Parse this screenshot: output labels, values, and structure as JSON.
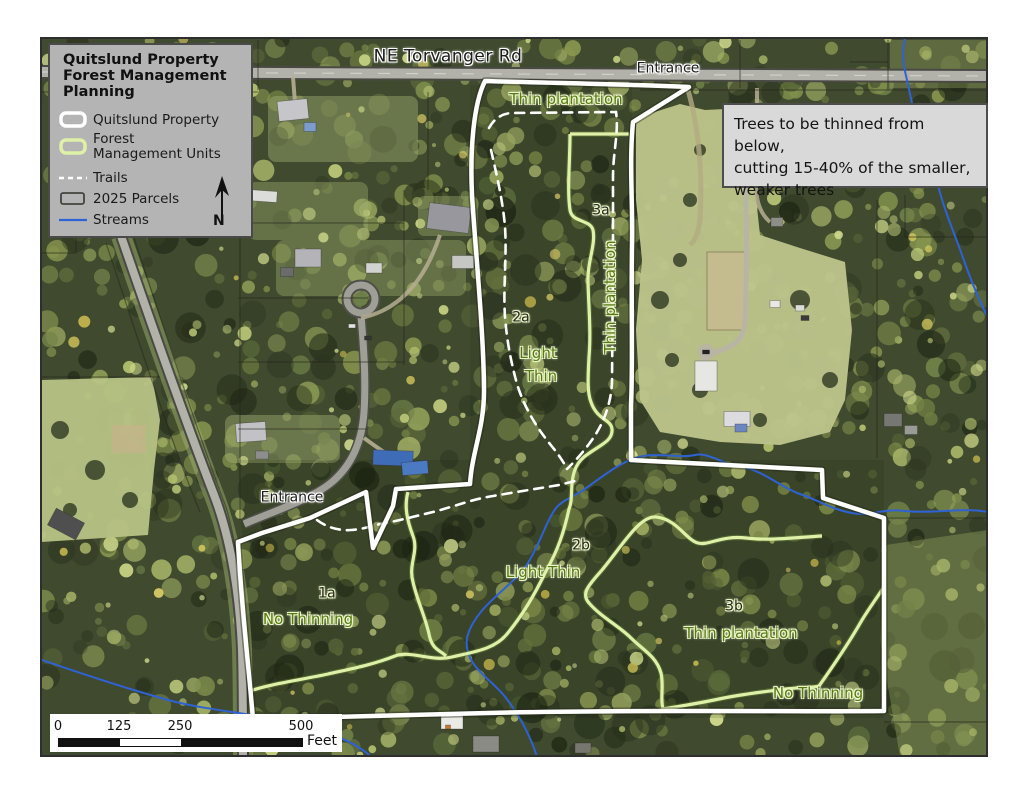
{
  "legend": {
    "title_lines": [
      "Quitslund Property",
      "Forest Management",
      "Planning"
    ],
    "items": [
      {
        "id": "quitslund-property",
        "label": "Quitslund Property",
        "label2": "",
        "symbol": "white-outline"
      },
      {
        "id": "forest-management-units",
        "label": "Forest",
        "label2": "Management Units",
        "symbol": "green-outline"
      },
      {
        "id": "trails",
        "label": "Trails",
        "label2": "",
        "symbol": "white-dash"
      },
      {
        "id": "parcels-2025",
        "label": "2025 Parcels",
        "label2": "",
        "symbol": "dark-rect"
      },
      {
        "id": "streams",
        "label": "Streams",
        "label2": "",
        "symbol": "blue-line"
      }
    ],
    "north_arrow_letter": "N"
  },
  "note_box": {
    "lines": [
      "Trees to be thinned from below,",
      "cutting 15-40% of the smaller,",
      "weaker trees"
    ]
  },
  "scalebar": {
    "ticks": [
      {
        "label": "0",
        "x": 58
      },
      {
        "label": "125",
        "x": 119
      },
      {
        "label": "250",
        "x": 180
      },
      {
        "label": "500",
        "x": 301
      }
    ],
    "unit": "Feet"
  },
  "map_labels": [
    {
      "id": "road-ne-torvanger-rd",
      "text": "NE Torvanger Rd",
      "x": 448,
      "y": 57,
      "kind": "road",
      "rotate": 0
    },
    {
      "id": "entrance-top",
      "text": "Entrance",
      "x": 668,
      "y": 69,
      "kind": "entrance",
      "rotate": 0
    },
    {
      "id": "unit-top-thin-plantation",
      "text": "Thin plantation",
      "x": 566,
      "y": 99,
      "kind": "unit-name",
      "rotate": 0
    },
    {
      "id": "unit-3a-id",
      "text": "3a",
      "x": 601,
      "y": 211,
      "kind": "unit-id",
      "rotate": 0
    },
    {
      "id": "unit-3a-name",
      "text": "Thin plantation",
      "x": 610,
      "y": 297,
      "kind": "unit-name",
      "rotate": -90
    },
    {
      "id": "unit-2a-id",
      "text": "2a",
      "x": 521,
      "y": 318,
      "kind": "unit-id",
      "rotate": 0
    },
    {
      "id": "unit-2a-name-line1",
      "text": "Light",
      "x": 538,
      "y": 353,
      "kind": "unit-name",
      "rotate": 0
    },
    {
      "id": "unit-2a-name-line2",
      "text": "Thin",
      "x": 541,
      "y": 376,
      "kind": "unit-name",
      "rotate": 0
    },
    {
      "id": "entrance-west",
      "text": "Entrance",
      "x": 292,
      "y": 498,
      "kind": "entrance",
      "rotate": 0
    },
    {
      "id": "unit-2b-id",
      "text": "2b",
      "x": 581,
      "y": 546,
      "kind": "unit-id",
      "rotate": 0
    },
    {
      "id": "unit-2b-name",
      "text": "Light Thin",
      "x": 543,
      "y": 572,
      "kind": "unit-name",
      "rotate": 0
    },
    {
      "id": "unit-1a-id",
      "text": "1a",
      "x": 327,
      "y": 594,
      "kind": "unit-id",
      "rotate": 0
    },
    {
      "id": "unit-1a-name",
      "text": "No Thinning",
      "x": 308,
      "y": 619,
      "kind": "unit-name",
      "rotate": 0
    },
    {
      "id": "unit-3b-id",
      "text": "3b",
      "x": 734,
      "y": 607,
      "kind": "unit-id",
      "rotate": 0
    },
    {
      "id": "unit-3b-name",
      "text": "Thin plantation",
      "x": 741,
      "y": 633,
      "kind": "unit-name",
      "rotate": 0
    },
    {
      "id": "unit-3b-nothin",
      "text": "No Thinning",
      "x": 818,
      "y": 693,
      "kind": "unit-name",
      "rotate": 0
    }
  ],
  "colors": {
    "property_boundary": "#ffffff",
    "fmu_green": "#dff0a8",
    "fmu_glow": "#74903c",
    "trail_white": "#ffffff",
    "parcel_dark": "#23231b",
    "stream_blue": "#2f62d4",
    "road_fill": "#b2b2aa",
    "road_edge": "#4a4a44",
    "label_green": "#567a12",
    "label_dark": "#1c1c1c",
    "halo_white": "#ffffff",
    "halo_green": "#eef6cc",
    "legend_bg": "#b4b4b4",
    "note_bg": "#d9d9d9",
    "frame_dark": "#2e2e2e",
    "forest_base": "#3f4a2e"
  }
}
